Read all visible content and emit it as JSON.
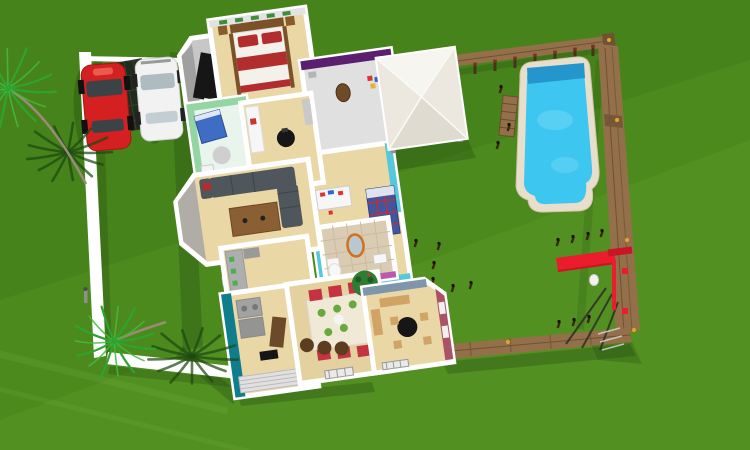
{
  "canvas": {
    "width": 750,
    "height": 450
  },
  "scene": {
    "type": "3d-home-plan-aerial-render",
    "objects": [
      "lawn",
      "boundary-wall",
      "red-car",
      "white-car",
      "carport-trellis",
      "palm-trees",
      "house-floor-plan",
      "gazebo",
      "wooden-fence",
      "swimming-pool",
      "pool-lounger",
      "slide-playset",
      "yard-stakes"
    ],
    "rooms": [
      "utility-room",
      "master-bedroom",
      "purple-bedroom",
      "kids-bedroom",
      "nursery",
      "office",
      "living-room",
      "kitchen",
      "bathroom",
      "laundry-room",
      "dining-room",
      "study"
    ]
  },
  "colors": {
    "grass": "#4c8a1e",
    "grass_dark_overlay": "#3d7417",
    "grass_light_overlay": "#63a22c",
    "streak": "#8cc355",
    "shadow": "#1c3a0e",
    "wall_white": "#ffffff",
    "wood_floor": "#ead7a6",
    "gray_floor": "#c7c7c7",
    "fence_wood": "#93704a",
    "fence_wood_dark": "#6f5233",
    "fence_post": "#4a3418",
    "baluster_top": "#7c3220",
    "knob_yellow": "#e0a32e",
    "pool_border": "#e7decb",
    "pool_water": "#3dc6f0",
    "pool_steps": "#2496cc",
    "pool_highlight": "#8ae2f8",
    "gazebo_light": "#f7f5f0",
    "gazebo_mid": "#ece8df",
    "gazebo_dark": "#dfdbd1",
    "car_red": "#d42020",
    "car_glass": "#3c4347",
    "car_white": "#f2f2f2",
    "car_white_glass": "#aebcc2",
    "trellis": "#20261f",
    "slide_red": "#ea1c2d",
    "slide_red_dark": "#c91525",
    "palm_green": "#2fa32f",
    "palm_green2": "#45bb3c",
    "palm_shadow": "#1d4a10",
    "trunk": "#9b8a7a",
    "purple_wall": "#5c1e6e",
    "teal_wall": "#57c8da",
    "teal_dark": "#0f7d8c",
    "green_wall": "#93d6a4",
    "nursery_floor": "#e9f4ec",
    "sofa": "#4f565c",
    "coffee_table": "#8a5f33",
    "bed_red": "#b22e2e",
    "bed_white": "#f3f1ea",
    "headboard": "#7c5128",
    "chair_red": "#c53343",
    "plate_green": "#67a93e",
    "stool_brown": "#5d3d20",
    "plant_green": "#2e7d32",
    "black": "#161616",
    "tile": "#d9ccb3",
    "maroon_wall": "#ab5266",
    "bluegray_wall": "#7d96aa",
    "counter_gray": "#aeaeae",
    "desk_white": "#f6f6f6",
    "desk_wood": "#d1a465",
    "orange_ring": "#d2701e",
    "plaid_blue": "#44549e",
    "mirror_gray": "#b9c7cf",
    "dining_floor": "#e4d1a0",
    "wall_trim_green": "#3f8c3f"
  },
  "scatter": {
    "posts": [
      [
        500,
        92
      ],
      [
        508,
        130
      ],
      [
        497,
        148
      ],
      [
        463,
        136
      ],
      [
        415,
        246
      ],
      [
        433,
        268
      ],
      [
        438,
        249
      ],
      [
        432,
        284
      ],
      [
        452,
        291
      ],
      [
        470,
        288
      ],
      [
        557,
        245
      ],
      [
        572,
        242
      ],
      [
        587,
        239
      ],
      [
        601,
        236
      ],
      [
        558,
        327
      ],
      [
        573,
        325
      ],
      [
        588,
        322
      ],
      [
        185,
        80
      ],
      [
        190,
        100
      ],
      [
        196,
        122
      ]
    ],
    "balusters": [
      [
        455,
        68
      ],
      [
        475,
        65
      ],
      [
        495,
        62
      ],
      [
        515,
        59
      ],
      [
        535,
        56
      ],
      [
        555,
        53
      ],
      [
        575,
        50
      ],
      [
        593,
        47
      ]
    ],
    "knobs": [
      [
        609,
        40
      ],
      [
        617,
        120
      ],
      [
        627,
        240
      ],
      [
        634,
        330
      ],
      [
        508,
        342
      ],
      [
        446,
        351
      ]
    ]
  },
  "palms": [
    {
      "name": "palm-top-left",
      "cx": 8,
      "cy": 88,
      "r": 48,
      "fronds": 15,
      "kind": "bright",
      "squash": 0.9,
      "offset": 5
    },
    {
      "name": "palm-bottom-left",
      "cx": 114,
      "cy": 341,
      "r": 42,
      "fronds": 15,
      "kind": "bright",
      "squash": 0.9,
      "offset": 12
    },
    {
      "name": "palm-shadow-top",
      "cx": 68,
      "cy": 152,
      "r": 44,
      "fronds": 13,
      "kind": "shadow",
      "squash": 0.7,
      "offset": 0
    },
    {
      "name": "palm-shadow-bottom",
      "cx": 192,
      "cy": 356,
      "r": 46,
      "fronds": 13,
      "kind": "shadow",
      "squash": 0.65,
      "offset": 7
    }
  ]
}
